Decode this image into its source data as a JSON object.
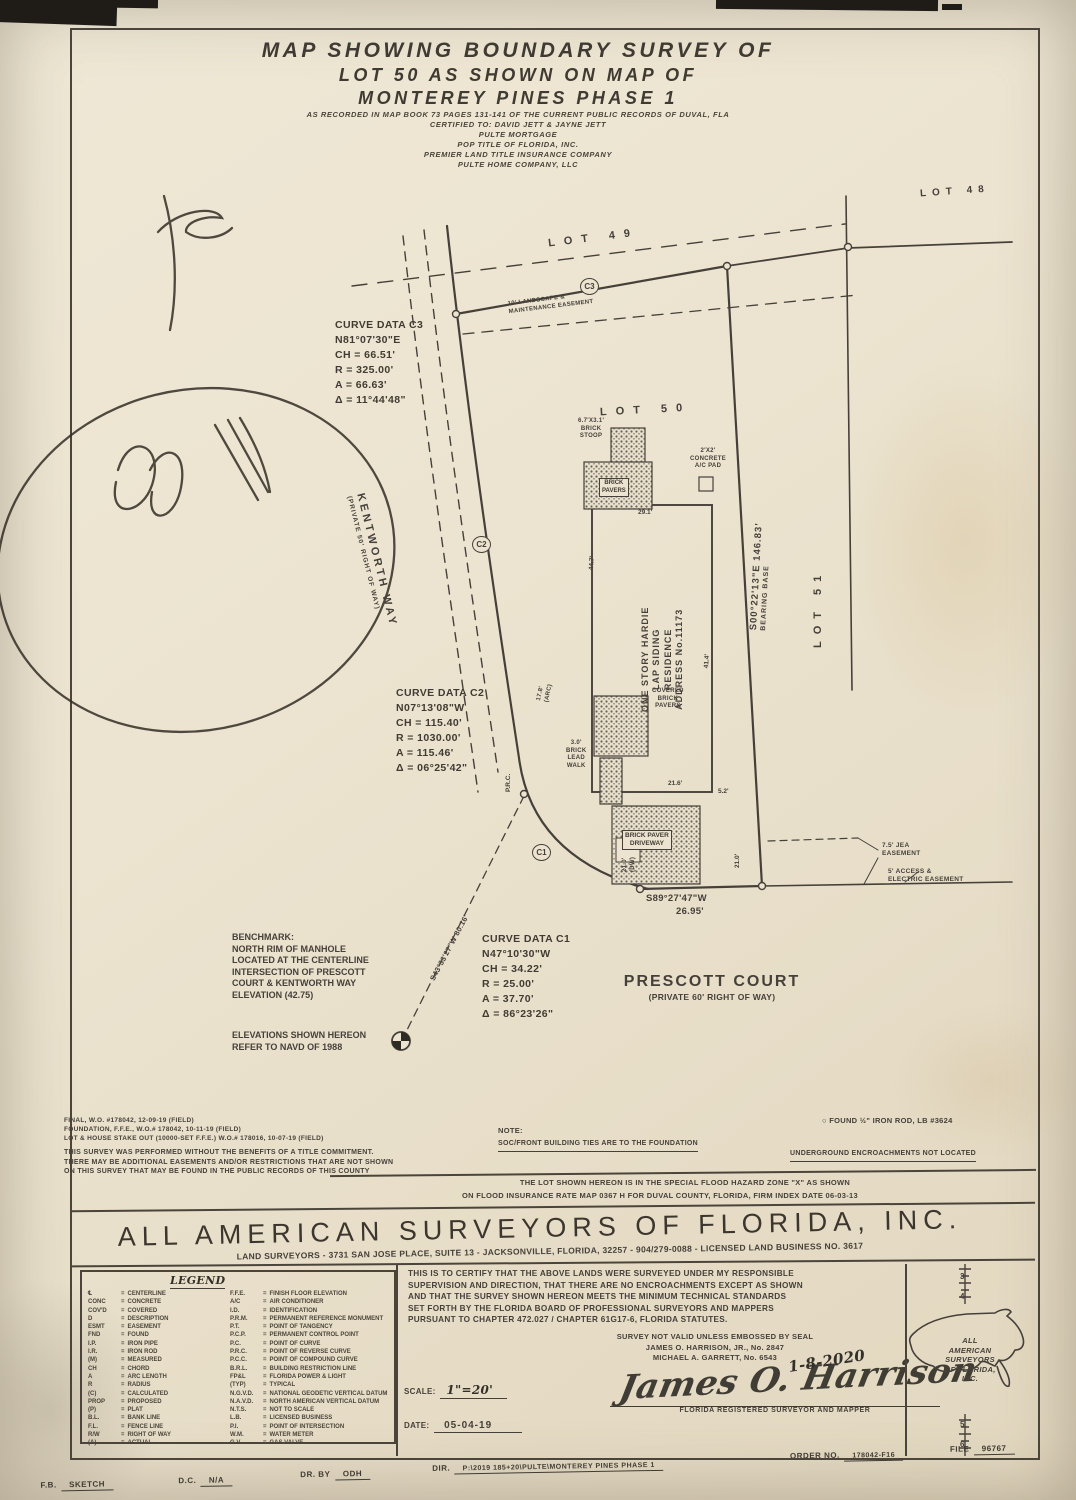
{
  "colors": {
    "paper": "#ece4d0",
    "ink": "#46403a",
    "photo_bg": "#948e82"
  },
  "title_block": {
    "main": [
      "MAP SHOWING BOUNDARY SURVEY OF",
      "LOT 50 AS SHOWN ON MAP OF",
      "MONTEREY PINES PHASE 1"
    ],
    "sub": [
      "AS RECORDED IN MAP BOOK 73 PAGES 131-141 OF THE CURRENT PUBLIC RECORDS OF DUVAL, FLA",
      "CERTIFIED TO: DAVID JETT & JAYNE JETT",
      "PULTE MORTGAGE",
      "POP TITLE OF FLORIDA, INC.",
      "PREMIER LAND TITLE INSURANCE COMPANY",
      "PULTE HOME COMPANY, LLC"
    ]
  },
  "map": {
    "lots": {
      "lot48": "LOT 48",
      "lot49": "LOT 49",
      "lot50": "LOT 50",
      "lot51": "LOT 51"
    },
    "streets": {
      "kentworth_name": "KENTWORTH WAY",
      "kentworth_row": "(PRIVATE 50' RIGHT OF WAY)",
      "prescott_name": "PRESCOTT COURT",
      "prescott_row": "(PRIVATE 60' RIGHT OF WAY)"
    },
    "curves": {
      "c3": [
        "CURVE DATA C3",
        "N81°07'30\"E",
        "CH = 66.51'",
        "R = 325.00'",
        "A = 66.63'",
        "Δ = 11°44'48\""
      ],
      "c2": [
        "CURVE DATA C2",
        "N07°13'08\"W",
        "CH = 115.40'",
        "R = 1030.00'",
        "A = 115.46'",
        "Δ = 06°25'42\""
      ],
      "c1": [
        "CURVE DATA C1",
        "N47°10'30\"W",
        "CH = 34.22'",
        "R = 25.00'",
        "A = 37.70'",
        "Δ = 86°23'26\""
      ]
    },
    "markers": {
      "c3": "C3",
      "c2": "C2",
      "c1": "C1",
      "prc": "P.R.C."
    },
    "bearings": {
      "east": "S00°22'13\"E 146.83'",
      "east_note": "BEARING BASE",
      "south": "S89°27'47\"W",
      "south_dist": "26.95'",
      "tie": "S43°33'27\"W 80.16'"
    },
    "easements": {
      "landscape": [
        "10' LANDSCAPE &",
        "MAINTENANCE EASEMENT"
      ],
      "jea": [
        "7.5' JEA",
        "EASEMENT"
      ],
      "access": [
        "5' ACCESS &",
        "ELECTRIC EASEMENT"
      ]
    },
    "house": [
      "ONE STORY HARDIE",
      "LAP SIDING",
      "RESIDENCE",
      "ADDRESS No.11173"
    ],
    "features": {
      "stoop": [
        "6.7'X3.1'",
        "BRICK",
        "STOOP"
      ],
      "pavers": [
        "BRICK",
        "PAVERS"
      ],
      "acpad": [
        "2'X2'",
        "CONCRETE",
        "A/C PAD"
      ],
      "covered": [
        "COVERED",
        "BRICK",
        "PAVERS"
      ],
      "leadwalk": [
        "3.0'",
        "BRICK",
        "LEAD",
        "WALK"
      ],
      "driveway": [
        "BRICK PAVER",
        "DRIVEWAY"
      ]
    },
    "dims": {
      "top": "29.1'",
      "left": "44.7'",
      "right": "41.4'",
      "bottom": "21.6'",
      "corner": "5.2'",
      "arc": [
        "17.8'",
        "(ARC)"
      ],
      "dw": [
        "21.0'",
        "(DW)"
      ],
      "dw2": "21.0'"
    },
    "benchmark": [
      "BENCHMARK:",
      "NORTH RIM OF MANHOLE",
      "LOCATED AT THE CENTERLINE",
      "INTERSECTION OF PRESCOTT",
      "COURT & KENTWORTH WAY",
      "ELEVATION (42.75)"
    ],
    "elev_note": [
      "ELEVATIONS SHOWN HEREON",
      "REFER TO NAVD OF 1988"
    ]
  },
  "notes": {
    "field": [
      "FINAL, W.O. #178042, 12-09-19 (FIELD)",
      "FOUNDATION, F.F.E., W.O.# 178042, 10-11-19 (FIELD)",
      "LOT & HOUSE STAKE OUT (10000-SET F.F.E.) W.O.# 178016, 10-07-19 (FIELD)"
    ],
    "title_note": [
      "THIS SURVEY WAS PERFORMED WITHOUT THE BENEFITS OF A TITLE COMMITMENT.",
      "THERE MAY BE ADDITIONAL EASEMENTS AND/OR RESTRICTIONS THAT ARE NOT SHOWN",
      "ON THIS SURVEY THAT MAY BE FOUND IN THE PUBLIC RECORDS OF THIS COUNTY"
    ],
    "note_label": "NOTE:",
    "soc": "SOC/FRONT BUILDING TIES ARE TO THE FOUNDATION",
    "found_icon": "○",
    "found": "FOUND ½\" IRON ROD, LB #3624",
    "underground": "UNDERGROUND ENCROACHMENTS NOT LOCATED",
    "flood1": "THE LOT SHOWN HEREON IS IN THE SPECIAL FLOOD HAZARD ZONE \"X\" AS SHOWN",
    "flood2": "ON FLOOD INSURANCE RATE MAP 0367 H FOR DUVAL COUNTY, FLORIDA, FIRM INDEX DATE 06-03-13"
  },
  "company": {
    "name": "ALL AMERICAN SURVEYORS OF FLORIDA, INC.",
    "address": "LAND SURVEYORS - 3731 SAN JOSE PLACE, SUITE 13 - JACKSONVILLE, FLORIDA, 32257 - 904/279-0088 - LICENSED LAND BUSINESS NO. 3617"
  },
  "legend": {
    "title": "LEGEND",
    "eq": "=",
    "left": [
      {
        "a": "℄",
        "m": "CENTERLINE"
      },
      {
        "a": "CONC",
        "m": "CONCRETE"
      },
      {
        "a": "COV'D",
        "m": "COVERED"
      },
      {
        "a": "D",
        "m": "DESCRIPTION"
      },
      {
        "a": "ESMT",
        "m": "EASEMENT"
      },
      {
        "a": "FND",
        "m": "FOUND"
      },
      {
        "a": "I.P.",
        "m": "IRON PIPE"
      },
      {
        "a": "I.R.",
        "m": "IRON ROD"
      },
      {
        "a": "(M)",
        "m": "MEASURED"
      },
      {
        "a": "CH",
        "m": "CHORD"
      },
      {
        "a": "A",
        "m": "ARC LENGTH"
      },
      {
        "a": "R",
        "m": "RADIUS"
      },
      {
        "a": "(C)",
        "m": "CALCULATED"
      },
      {
        "a": "PROP",
        "m": "PROPOSED"
      },
      {
        "a": "(P)",
        "m": "PLAT"
      },
      {
        "a": "B.L.",
        "m": "BANK LINE"
      },
      {
        "a": "F.L.",
        "m": "FENCE LINE"
      },
      {
        "a": "R/W",
        "m": "RIGHT OF WAY"
      },
      {
        "a": "(A)",
        "m": "ACTUAL"
      }
    ],
    "right": [
      {
        "a": "F.F.E.",
        "m": "FINISH FLOOR ELEVATION"
      },
      {
        "a": "A/C",
        "m": "AIR CONDITIONER"
      },
      {
        "a": "I.D.",
        "m": "IDENTIFICATION"
      },
      {
        "a": "P.R.M.",
        "m": "PERMANENT REFERENCE MONUMENT"
      },
      {
        "a": "P.T.",
        "m": "POINT OF TANGENCY"
      },
      {
        "a": "P.C.P.",
        "m": "PERMANENT CONTROL POINT"
      },
      {
        "a": "P.C.",
        "m": "POINT OF CURVE"
      },
      {
        "a": "P.R.C.",
        "m": "POINT OF REVERSE CURVE"
      },
      {
        "a": "P.C.C.",
        "m": "POINT OF COMPOUND CURVE"
      },
      {
        "a": "B.R.L.",
        "m": "BUILDING RESTRICTION LINE"
      },
      {
        "a": "FP&L",
        "m": "FLORIDA POWER & LIGHT"
      },
      {
        "a": "(TYP)",
        "m": "TYPICAL"
      },
      {
        "a": "N.G.V.D.",
        "m": "NATIONAL GEODETIC VERTICAL DATUM"
      },
      {
        "a": "N.A.V.D.",
        "m": "NORTH AMERICAN VERTICAL DATUM"
      },
      {
        "a": "N.T.S.",
        "m": "NOT TO SCALE"
      },
      {
        "a": "L.B.",
        "m": "LICENSED BUSINESS"
      },
      {
        "a": "P.I.",
        "m": "POINT OF INTERSECTION"
      },
      {
        "a": "W.M.",
        "m": "WATER METER"
      },
      {
        "a": "G.V.",
        "m": "GAS VALVE"
      }
    ]
  },
  "certification": {
    "lines": [
      "THIS IS TO CERTIFY THAT THE ABOVE LANDS WERE SURVEYED UNDER MY RESPONSIBLE",
      "SUPERVISION AND DIRECTION, THAT THERE ARE NO ENCROACHMENTS EXCEPT AS SHOWN",
      "AND THAT THE SURVEY SHOWN HEREON MEETS THE MINIMUM TECHNICAL STANDARDS",
      "SET FORTH BY THE FLORIDA BOARD OF PROFESSIONAL SURVEYORS AND MAPPERS",
      "PURSUANT TO CHAPTER 472.027 / CHAPTER 61G17-6, FLORIDA STATUTES."
    ],
    "seal": [
      "SURVEY NOT VALID UNLESS EMBOSSED BY SEAL",
      "JAMES O. HARRISON, JR., No. 2847",
      "MICHAEL A. GARRETT, No. 6543"
    ],
    "handdate": "1-8-2020",
    "scale_label": "SCALE:",
    "scale_value": "1\"=20'",
    "date_label": "DATE:",
    "date_value": "05-04-19",
    "signature": "James O. Harrison",
    "sig_caption": "FLORIDA REGISTERED SURVEYOR AND MAPPER"
  },
  "logo": {
    "lines": [
      "ALL",
      "AMERICAN",
      "SURVEYORS",
      "OF FLORIDA,",
      "INC."
    ],
    "ruler_top": [
      "3",
      "4"
    ],
    "ruler_bottom": [
      "5",
      "6"
    ]
  },
  "footer": {
    "fb_label": "F.B.",
    "fb": "SKETCH",
    "dc_label": "D.C.",
    "dc": "N/A",
    "drby_label": "DR. BY",
    "drby": "ODH",
    "dir_label": "DIR.",
    "dir": "P:\\2019 185+20\\PULTE\\MONTEREY PINES PHASE 1",
    "order_label": "ORDER NO.",
    "order": "178042-F16",
    "file_label": "FILE",
    "file": "96767"
  }
}
